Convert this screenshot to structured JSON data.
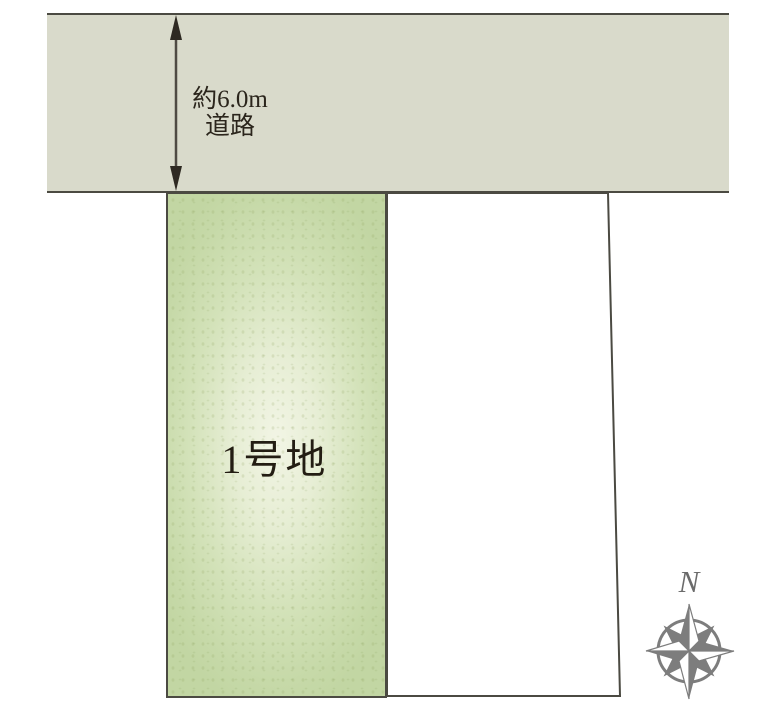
{
  "diagram": {
    "road": {
      "width_label": "約6.0m",
      "name_label": "道路",
      "fill": "#d9dacb",
      "border_color": "#4b4a42"
    },
    "lots": [
      {
        "id": "lot-1",
        "label": "1号地",
        "fill_edge": "#c6d9a8",
        "fill_center": "#f2f5e5"
      },
      {
        "id": "lot-2",
        "label": "",
        "fill": "#ffffff"
      }
    ],
    "arrow": {
      "color": "#2e2922"
    },
    "compass": {
      "north_label": "N",
      "color": "#7d7d7d"
    },
    "text_color": "#231d13"
  }
}
